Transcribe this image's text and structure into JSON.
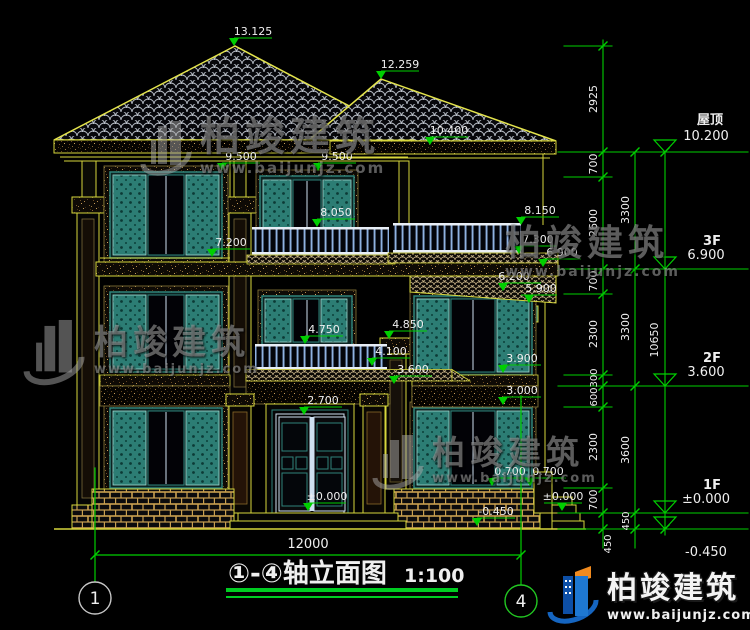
{
  "title": {
    "text": "①-④轴立面图",
    "scale": "1:100"
  },
  "axis": {
    "left_bubble": "1",
    "right_bubble": "4",
    "overall_width": "12000"
  },
  "levels": [
    {
      "label": "屋顶",
      "value": "10.200"
    },
    {
      "label": "3F",
      "value": "6.900"
    },
    {
      "label": "2F",
      "value": "3.600"
    },
    {
      "label": "1F",
      "value": "±0.000"
    },
    {
      "label": "",
      "value": "-0.450"
    }
  ],
  "elevations": [
    "13.125",
    "12.259",
    "10.400",
    "9.500",
    "9.500",
    "8.050",
    "8.150",
    "7.300",
    "7.200",
    "6.900",
    "6.200",
    "5.900",
    "4.750",
    "4.850",
    "4.100",
    "3.600",
    "3.900",
    "3.000",
    "2.700",
    "±0.000",
    "0.700",
    "0.700",
    "±0.000",
    "-0.450"
  ],
  "dim_chains": {
    "inner": [
      "2925",
      "700",
      "2600",
      "700",
      "2300",
      "300",
      "600",
      "2300",
      "700",
      "450"
    ],
    "middle": [
      "3300",
      "3300",
      "3600",
      "450"
    ],
    "outer": [
      "10650"
    ]
  },
  "watermark": {
    "brand": "柏竣建筑",
    "url": "www.baijunjz.com"
  },
  "colors": {
    "cad_yellow": "#d6d63c",
    "cad_green": "#00cf00",
    "shutter_teal": "#2c7d74",
    "railing_blue": "#8fb2e2"
  }
}
